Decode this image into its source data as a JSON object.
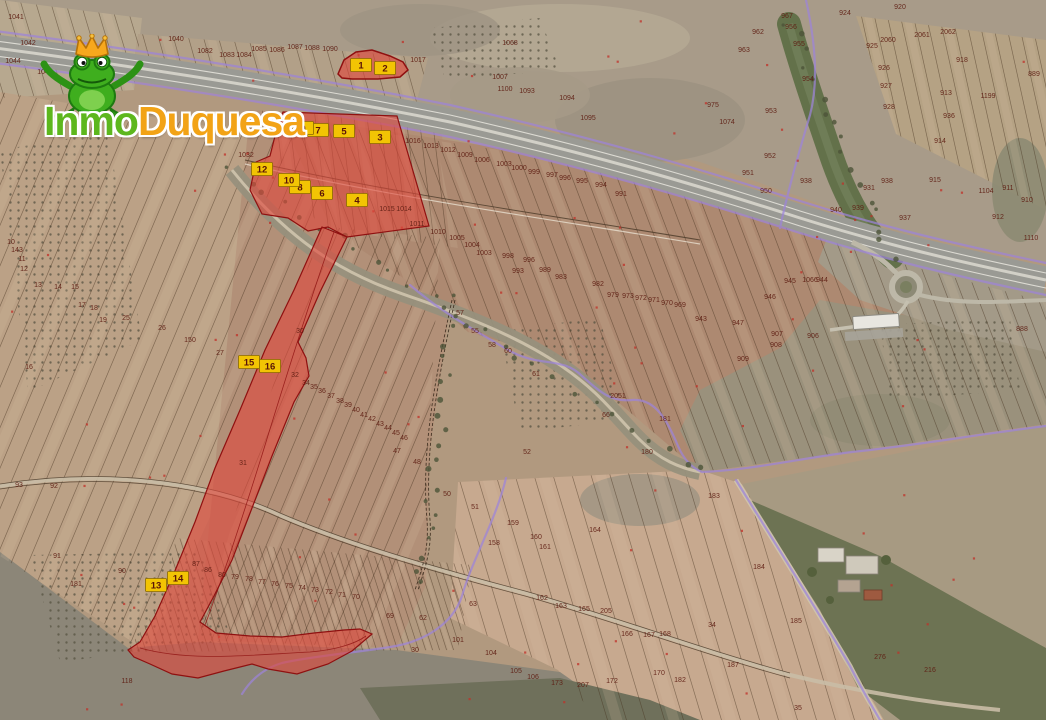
{
  "watermark": {
    "brand_part1": "Inmo",
    "brand_part2": "Duquesa",
    "part1_color": "#5db71d",
    "part2_color": "#f2a316",
    "mascot": "frog-with-crown"
  },
  "map": {
    "type": "cadastral-aerial-overlay",
    "highlight_color": "#e1463a",
    "marker_fill": "#f2c404",
    "marker_text_color": "#5a1408",
    "boundary_color": "#9d84da",
    "markers": [
      {
        "label": "1",
        "x": 361,
        "y": 65
      },
      {
        "label": "2",
        "x": 385,
        "y": 68
      },
      {
        "label": "3",
        "x": 380,
        "y": 137
      },
      {
        "label": "4",
        "x": 357,
        "y": 200
      },
      {
        "label": "5",
        "x": 344,
        "y": 131
      },
      {
        "label": "6",
        "x": 322,
        "y": 193
      },
      {
        "label": "7",
        "x": 318,
        "y": 130
      },
      {
        "label": "8",
        "x": 300,
        "y": 187
      },
      {
        "label": "9",
        "x": 303,
        "y": 128
      },
      {
        "label": "10",
        "x": 289,
        "y": 180
      },
      {
        "label": "12",
        "x": 262,
        "y": 169
      },
      {
        "label": "13",
        "x": 156,
        "y": 585
      },
      {
        "label": "14",
        "x": 178,
        "y": 578
      },
      {
        "label": "15",
        "x": 249,
        "y": 362
      },
      {
        "label": "16",
        "x": 270,
        "y": 366
      }
    ],
    "parcel_labels": [
      {
        "t": "1041",
        "x": 16,
        "y": 19
      },
      {
        "t": "1042",
        "x": 28,
        "y": 45
      },
      {
        "t": "1044",
        "x": 13,
        "y": 63
      },
      {
        "t": "1043",
        "x": 45,
        "y": 74
      },
      {
        "t": "1040",
        "x": 176,
        "y": 41
      },
      {
        "t": "1082",
        "x": 205,
        "y": 53
      },
      {
        "t": "1083",
        "x": 227,
        "y": 57
      },
      {
        "t": "1084",
        "x": 244,
        "y": 57
      },
      {
        "t": "1085",
        "x": 259,
        "y": 51
      },
      {
        "t": "1086",
        "x": 277,
        "y": 52
      },
      {
        "t": "1087",
        "x": 295,
        "y": 49
      },
      {
        "t": "1088",
        "x": 312,
        "y": 50
      },
      {
        "t": "1090",
        "x": 330,
        "y": 51
      },
      {
        "t": "1017",
        "x": 418,
        "y": 62
      },
      {
        "t": "1068",
        "x": 510,
        "y": 45
      },
      {
        "t": "1007",
        "x": 500,
        "y": 79
      },
      {
        "t": "1100",
        "x": 505,
        "y": 91
      },
      {
        "t": "1093",
        "x": 527,
        "y": 93
      },
      {
        "t": "1094",
        "x": 567,
        "y": 100
      },
      {
        "t": "1095",
        "x": 588,
        "y": 120
      },
      {
        "t": "967",
        "x": 787,
        "y": 18
      },
      {
        "t": "956",
        "x": 791,
        "y": 29
      },
      {
        "t": "962",
        "x": 758,
        "y": 34
      },
      {
        "t": "963",
        "x": 744,
        "y": 52
      },
      {
        "t": "955",
        "x": 799,
        "y": 46
      },
      {
        "t": "954",
        "x": 808,
        "y": 81
      },
      {
        "t": "953",
        "x": 771,
        "y": 113
      },
      {
        "t": "952",
        "x": 770,
        "y": 158
      },
      {
        "t": "951",
        "x": 748,
        "y": 175
      },
      {
        "t": "950",
        "x": 766,
        "y": 193
      },
      {
        "t": "975",
        "x": 713,
        "y": 107
      },
      {
        "t": "1074",
        "x": 727,
        "y": 124
      },
      {
        "t": "924",
        "x": 845,
        "y": 15
      },
      {
        "t": "920",
        "x": 900,
        "y": 9
      },
      {
        "t": "925",
        "x": 872,
        "y": 48
      },
      {
        "t": "2060",
        "x": 888,
        "y": 42
      },
      {
        "t": "2061",
        "x": 922,
        "y": 37
      },
      {
        "t": "2062",
        "x": 948,
        "y": 34
      },
      {
        "t": "926",
        "x": 884,
        "y": 70
      },
      {
        "t": "927",
        "x": 886,
        "y": 88
      },
      {
        "t": "928",
        "x": 889,
        "y": 109
      },
      {
        "t": "918",
        "x": 962,
        "y": 62
      },
      {
        "t": "913",
        "x": 946,
        "y": 95
      },
      {
        "t": "936",
        "x": 949,
        "y": 118
      },
      {
        "t": "914",
        "x": 940,
        "y": 143
      },
      {
        "t": "915",
        "x": 935,
        "y": 182
      },
      {
        "t": "889",
        "x": 1034,
        "y": 76
      },
      {
        "t": "1199",
        "x": 988,
        "y": 98
      },
      {
        "t": "938",
        "x": 806,
        "y": 183
      },
      {
        "t": "940",
        "x": 836,
        "y": 212
      },
      {
        "t": "939",
        "x": 858,
        "y": 210
      },
      {
        "t": "931",
        "x": 869,
        "y": 190
      },
      {
        "t": "937",
        "x": 905,
        "y": 220
      },
      {
        "t": "938",
        "x": 887,
        "y": 183
      },
      {
        "t": "912",
        "x": 998,
        "y": 219
      },
      {
        "t": "911",
        "x": 1008,
        "y": 190
      },
      {
        "t": "910",
        "x": 1027,
        "y": 202
      },
      {
        "t": "1104",
        "x": 986,
        "y": 193
      },
      {
        "t": "1110",
        "x": 1031,
        "y": 240
      },
      {
        "t": "1032",
        "x": 246,
        "y": 157
      },
      {
        "t": "1025",
        "x": 291,
        "y": 128
      },
      {
        "t": "1016",
        "x": 413,
        "y": 143
      },
      {
        "t": "1013",
        "x": 431,
        "y": 148
      },
      {
        "t": "1012",
        "x": 448,
        "y": 152
      },
      {
        "t": "1009",
        "x": 465,
        "y": 157
      },
      {
        "t": "1006",
        "x": 482,
        "y": 162
      },
      {
        "t": "1003",
        "x": 504,
        "y": 166
      },
      {
        "t": "1000",
        "x": 519,
        "y": 170
      },
      {
        "t": "999",
        "x": 534,
        "y": 174
      },
      {
        "t": "997",
        "x": 552,
        "y": 177
      },
      {
        "t": "996",
        "x": 565,
        "y": 180
      },
      {
        "t": "995",
        "x": 582,
        "y": 183
      },
      {
        "t": "994",
        "x": 601,
        "y": 187
      },
      {
        "t": "991",
        "x": 621,
        "y": 196
      },
      {
        "t": "1015",
        "x": 387,
        "y": 211
      },
      {
        "t": "1014",
        "x": 404,
        "y": 211
      },
      {
        "t": "1011",
        "x": 417,
        "y": 226
      },
      {
        "t": "1010",
        "x": 438,
        "y": 234
      },
      {
        "t": "1005",
        "x": 457,
        "y": 240
      },
      {
        "t": "1004",
        "x": 472,
        "y": 247
      },
      {
        "t": "1003",
        "x": 484,
        "y": 255
      },
      {
        "t": "998",
        "x": 508,
        "y": 258
      },
      {
        "t": "996",
        "x": 529,
        "y": 262
      },
      {
        "t": "993",
        "x": 518,
        "y": 273
      },
      {
        "t": "989",
        "x": 545,
        "y": 272
      },
      {
        "t": "983",
        "x": 561,
        "y": 279
      },
      {
        "t": "982",
        "x": 598,
        "y": 286
      },
      {
        "t": "979",
        "x": 613,
        "y": 297
      },
      {
        "t": "973",
        "x": 628,
        "y": 298
      },
      {
        "t": "972",
        "x": 641,
        "y": 300
      },
      {
        "t": "971",
        "x": 654,
        "y": 302
      },
      {
        "t": "970",
        "x": 667,
        "y": 305
      },
      {
        "t": "969",
        "x": 680,
        "y": 307
      },
      {
        "t": "943",
        "x": 701,
        "y": 321
      },
      {
        "t": "945",
        "x": 790,
        "y": 283
      },
      {
        "t": "1066",
        "x": 810,
        "y": 282
      },
      {
        "t": "944",
        "x": 822,
        "y": 282
      },
      {
        "t": "946",
        "x": 770,
        "y": 299
      },
      {
        "t": "947",
        "x": 738,
        "y": 325
      },
      {
        "t": "907",
        "x": 777,
        "y": 336
      },
      {
        "t": "906",
        "x": 813,
        "y": 338
      },
      {
        "t": "908",
        "x": 776,
        "y": 347
      },
      {
        "t": "909",
        "x": 743,
        "y": 361
      },
      {
        "t": "888",
        "x": 1022,
        "y": 331
      },
      {
        "t": "57",
        "x": 460,
        "y": 315
      },
      {
        "t": "55",
        "x": 475,
        "y": 333
      },
      {
        "t": "58",
        "x": 492,
        "y": 347
      },
      {
        "t": "60",
        "x": 508,
        "y": 353
      },
      {
        "t": "61",
        "x": 536,
        "y": 376
      },
      {
        "t": "66",
        "x": 606,
        "y": 417
      },
      {
        "t": "2051",
        "x": 618,
        "y": 398
      },
      {
        "t": "181",
        "x": 665,
        "y": 421
      },
      {
        "t": "180",
        "x": 647,
        "y": 454
      },
      {
        "t": "52",
        "x": 527,
        "y": 454
      },
      {
        "t": "47",
        "x": 397,
        "y": 453
      },
      {
        "t": "48",
        "x": 417,
        "y": 464
      },
      {
        "t": "50",
        "x": 447,
        "y": 496
      },
      {
        "t": "51",
        "x": 475,
        "y": 509
      },
      {
        "t": "10",
        "x": 11,
        "y": 244
      },
      {
        "t": "143",
        "x": 17,
        "y": 252
      },
      {
        "t": "11",
        "x": 22,
        "y": 261
      },
      {
        "t": "12",
        "x": 24,
        "y": 271
      },
      {
        "t": "13",
        "x": 38,
        "y": 287
      },
      {
        "t": "14",
        "x": 58,
        "y": 289
      },
      {
        "t": "15",
        "x": 75,
        "y": 289
      },
      {
        "t": "17",
        "x": 82,
        "y": 307
      },
      {
        "t": "18",
        "x": 94,
        "y": 310
      },
      {
        "t": "19",
        "x": 103,
        "y": 322
      },
      {
        "t": "25",
        "x": 126,
        "y": 320
      },
      {
        "t": "26",
        "x": 162,
        "y": 330
      },
      {
        "t": "150",
        "x": 190,
        "y": 342
      },
      {
        "t": "27",
        "x": 220,
        "y": 355
      },
      {
        "t": "16",
        "x": 29,
        "y": 369
      },
      {
        "t": "30",
        "x": 300,
        "y": 333
      },
      {
        "t": "31",
        "x": 243,
        "y": 465
      },
      {
        "t": "32",
        "x": 295,
        "y": 377
      },
      {
        "t": "93",
        "x": 19,
        "y": 487
      },
      {
        "t": "92",
        "x": 54,
        "y": 488
      },
      {
        "t": "91",
        "x": 57,
        "y": 558
      },
      {
        "t": "181",
        "x": 76,
        "y": 586
      },
      {
        "t": "90",
        "x": 122,
        "y": 573
      },
      {
        "t": "118",
        "x": 127,
        "y": 683
      },
      {
        "t": "34",
        "x": 306,
        "y": 385
      },
      {
        "t": "35",
        "x": 314,
        "y": 389
      },
      {
        "t": "36",
        "x": 322,
        "y": 393
      },
      {
        "t": "37",
        "x": 331,
        "y": 398
      },
      {
        "t": "38",
        "x": 340,
        "y": 403
      },
      {
        "t": "39",
        "x": 348,
        "y": 407
      },
      {
        "t": "40",
        "x": 356,
        "y": 412
      },
      {
        "t": "41",
        "x": 364,
        "y": 417
      },
      {
        "t": "42",
        "x": 372,
        "y": 421
      },
      {
        "t": "43",
        "x": 380,
        "y": 426
      },
      {
        "t": "44",
        "x": 388,
        "y": 430
      },
      {
        "t": "45",
        "x": 396,
        "y": 435
      },
      {
        "t": "46",
        "x": 404,
        "y": 440
      },
      {
        "t": "87",
        "x": 196,
        "y": 566
      },
      {
        "t": "86",
        "x": 208,
        "y": 572
      },
      {
        "t": "80",
        "x": 222,
        "y": 577
      },
      {
        "t": "79",
        "x": 235,
        "y": 579
      },
      {
        "t": "78",
        "x": 249,
        "y": 581
      },
      {
        "t": "77",
        "x": 262,
        "y": 584
      },
      {
        "t": "76",
        "x": 275,
        "y": 586
      },
      {
        "t": "75",
        "x": 289,
        "y": 588
      },
      {
        "t": "74",
        "x": 302,
        "y": 590
      },
      {
        "t": "73",
        "x": 315,
        "y": 592
      },
      {
        "t": "72",
        "x": 329,
        "y": 594
      },
      {
        "t": "71",
        "x": 342,
        "y": 597
      },
      {
        "t": "70",
        "x": 356,
        "y": 599
      },
      {
        "t": "69",
        "x": 390,
        "y": 618
      },
      {
        "t": "62",
        "x": 423,
        "y": 620
      },
      {
        "t": "63",
        "x": 473,
        "y": 606
      },
      {
        "t": "101",
        "x": 458,
        "y": 642
      },
      {
        "t": "30",
        "x": 415,
        "y": 652
      },
      {
        "t": "104",
        "x": 491,
        "y": 655
      },
      {
        "t": "105",
        "x": 516,
        "y": 673
      },
      {
        "t": "106",
        "x": 533,
        "y": 679
      },
      {
        "t": "158",
        "x": 494,
        "y": 545
      },
      {
        "t": "159",
        "x": 513,
        "y": 525
      },
      {
        "t": "160",
        "x": 536,
        "y": 539
      },
      {
        "t": "161",
        "x": 545,
        "y": 549
      },
      {
        "t": "164",
        "x": 595,
        "y": 532
      },
      {
        "t": "162",
        "x": 542,
        "y": 600
      },
      {
        "t": "163",
        "x": 561,
        "y": 608
      },
      {
        "t": "165",
        "x": 584,
        "y": 611
      },
      {
        "t": "205",
        "x": 606,
        "y": 613
      },
      {
        "t": "166",
        "x": 627,
        "y": 636
      },
      {
        "t": "167",
        "x": 649,
        "y": 637
      },
      {
        "t": "168",
        "x": 665,
        "y": 636
      },
      {
        "t": "170",
        "x": 659,
        "y": 675
      },
      {
        "t": "172",
        "x": 612,
        "y": 683
      },
      {
        "t": "182",
        "x": 680,
        "y": 682
      },
      {
        "t": "173",
        "x": 557,
        "y": 685
      },
      {
        "t": "207",
        "x": 583,
        "y": 687
      },
      {
        "t": "183",
        "x": 714,
        "y": 498
      },
      {
        "t": "184",
        "x": 759,
        "y": 569
      },
      {
        "t": "185",
        "x": 796,
        "y": 623
      },
      {
        "t": "34",
        "x": 712,
        "y": 627
      },
      {
        "t": "187",
        "x": 733,
        "y": 667
      },
      {
        "t": "216",
        "x": 930,
        "y": 672
      },
      {
        "t": "276",
        "x": 880,
        "y": 659
      },
      {
        "t": "35",
        "x": 798,
        "y": 710
      }
    ]
  }
}
